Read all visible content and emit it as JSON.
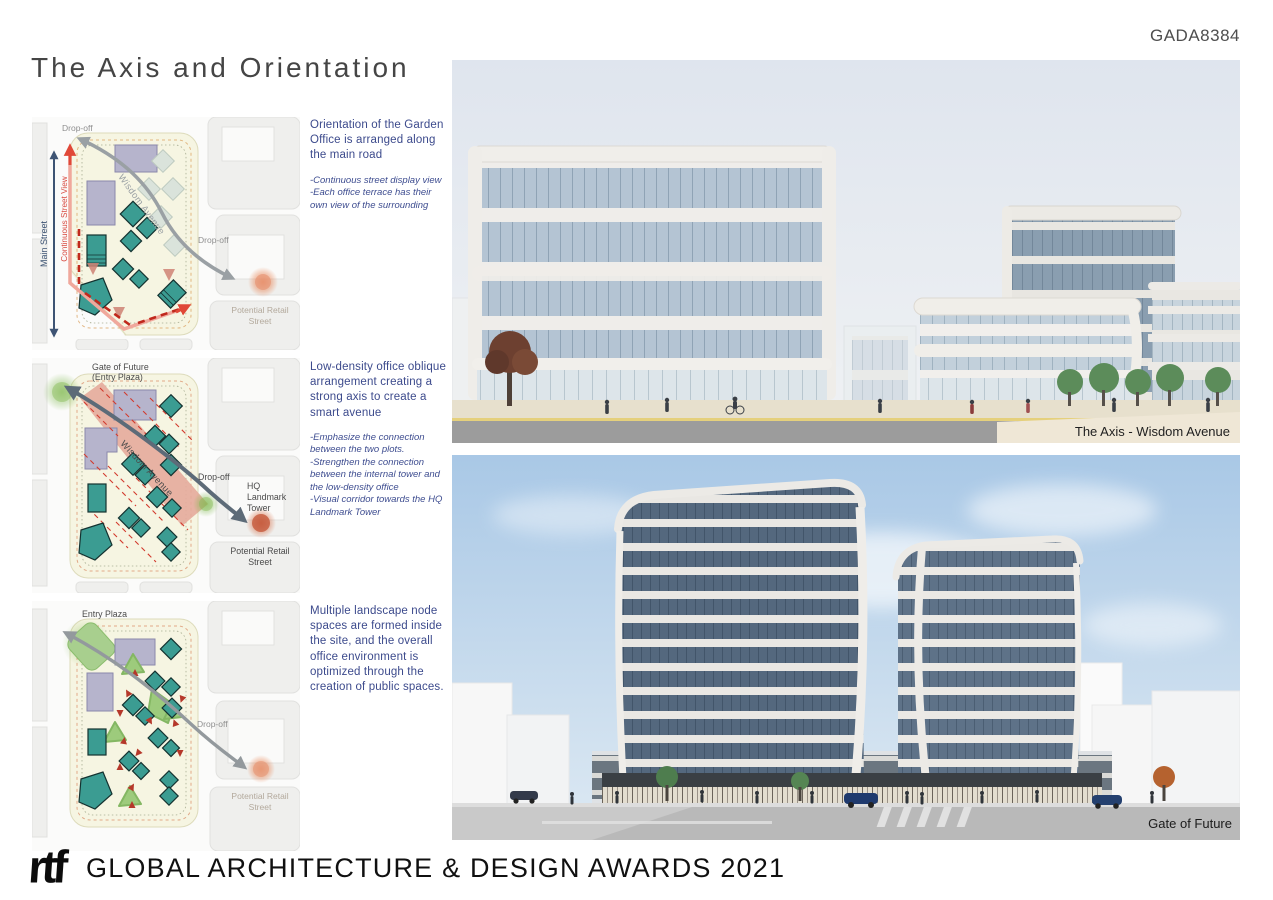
{
  "header": {
    "code": "GADA8384",
    "title": "The Axis and Orientation"
  },
  "notes": [
    {
      "heading": "Orientation of the Garden Office is arranged along the main road",
      "bullets": "-Continuous street display view\n-Each office terrace has their own view of the surrounding"
    },
    {
      "heading": "Low-density office oblique arrangement creating a strong axis to create a smart avenue",
      "bullets": "-Emphasize the connection between the two plots.\n-Strengthen the connection between the internal tower and the low-density office\n-Visual corridor towards the HQ Landmark Tower"
    },
    {
      "heading": "Multiple landscape node spaces are formed inside the site, and the overall office environment is optimized through the creation of public spaces.",
      "bullets": ""
    }
  ],
  "diagrams": {
    "d1": {
      "drop_off_top": "Drop-off",
      "main_street": "Main Street",
      "continuous_street_view": "Continuous Street View",
      "wisdom_avenue": "Wisdom Avenue",
      "drop_off_mid": "Drop-off",
      "retail_line1": "Potential Retail",
      "retail_line2": "Street"
    },
    "d2": {
      "gate_line1": "Gate of Future",
      "gate_line2": "(Entry Plaza)",
      "wisdom_avenue": "Wisdom Avenue",
      "drop_off": "Drop-off",
      "hq_line1": "HQ",
      "hq_line2": "Landmark",
      "hq_line3": "Tower",
      "retail_line1": "Potential Retail",
      "retail_line2": "Street"
    },
    "d3": {
      "entry_plaza": "Entry Plaza",
      "drop_off": "Drop-off",
      "retail_line1": "Potential Retail",
      "retail_line2": "Street"
    }
  },
  "renders": [
    {
      "caption": "The Axis - Wisdom Avenue"
    },
    {
      "caption": "Gate of Future"
    }
  ],
  "footer": {
    "logo_text": "rtf",
    "award_text": "GLOBAL ARCHITECTURE & DESIGN AWARDS 2021"
  },
  "colors": {
    "note_blue": "#3c4a8c",
    "teal_building": "#3b9c92",
    "plot_cream": "#f6f5e2",
    "avenue_pink": "#e5ab9c",
    "route_red": "#e04838",
    "dashed_red": "#c0281c",
    "arrow_gray": "#9aa0a4",
    "arrow_slate": "#5d6b78",
    "main_street_navy": "#3e5474",
    "landscape_green": "#9dcb7c",
    "retail_orange": "#d4764f",
    "caption_band_cream": "#efe7d6"
  }
}
